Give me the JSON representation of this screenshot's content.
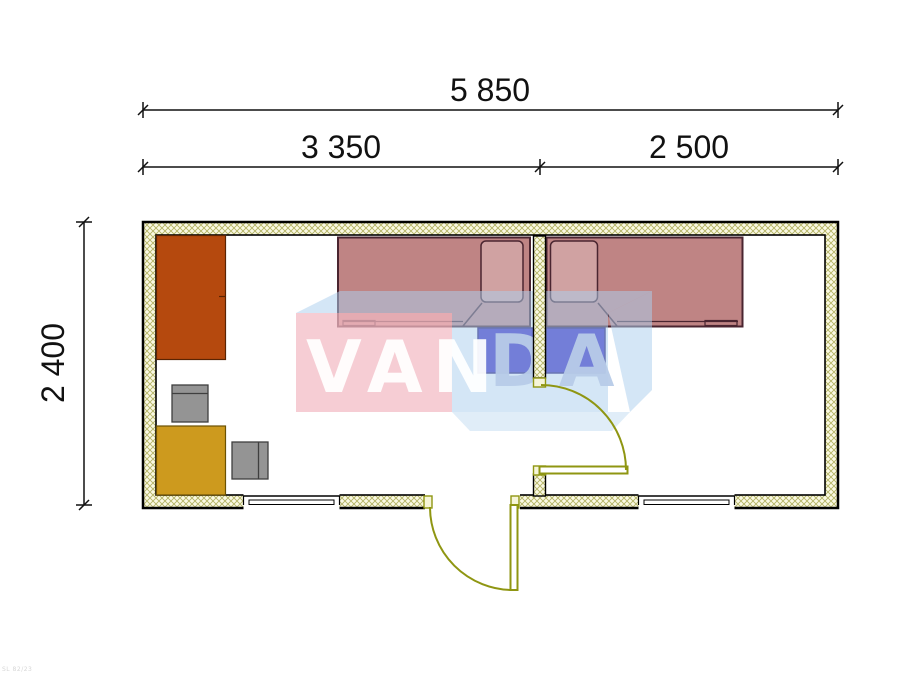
{
  "dimensions": {
    "overall": "5 850",
    "left_section": "3 350",
    "right_section": "2 500",
    "depth": "2 400"
  },
  "watermark": {
    "part1": "VAN",
    "part2": "DA"
  },
  "corner_note": "SL 82/23",
  "colors": {
    "wall_fill": "#faf9e3",
    "wall_hatch": "#b3b264",
    "wardrobe": "#b5490e",
    "table_gold": "#cd9a1e",
    "chair_gray": "#949494",
    "bed_fill": "rgba(173,97,97,0.78)",
    "bed_outline": "#4a2530",
    "pillow_fill": "rgba(236,214,214,0.38)",
    "desk_blue": "#3526c0",
    "door_olive": "#8f9612",
    "jamb_fill": "#f6f5d8",
    "watermark_pink": "rgba(242,186,196,0.72)",
    "watermark_blue": "rgba(173,207,238,0.52)",
    "watermark_blue_light": "rgba(186,216,240,0.45)",
    "wm_text_white": "rgba(255,255,255,0.93)",
    "wm_text_blue": "rgba(183,203,232,0.95)",
    "dim_color": "#111111"
  }
}
